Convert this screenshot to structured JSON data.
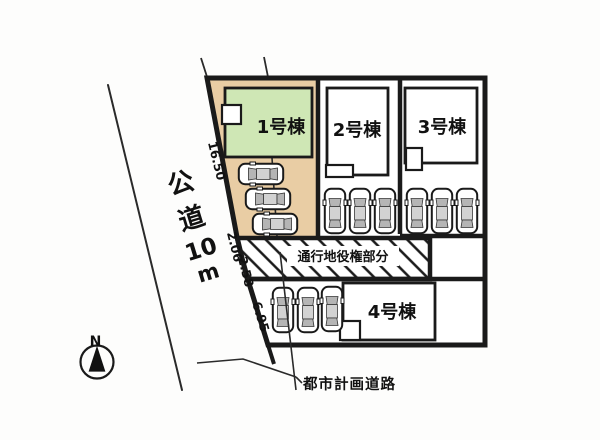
{
  "site_plan": {
    "buildings": [
      {
        "label": "1号棟"
      },
      {
        "label": "2号棟"
      },
      {
        "label": "3号棟"
      },
      {
        "label": "4号棟"
      }
    ],
    "dimensions": [
      "16.50",
      "2.06",
      "2.58",
      "6.95"
    ],
    "easement_label": "通行地役権部分",
    "planning_road_label": "都市計画道路",
    "road": {
      "label": "公道10m",
      "chars": [
        "公",
        "道",
        "10",
        "m"
      ]
    },
    "compass_label": "N",
    "parking_spaces": 12
  },
  "colors": {
    "lot1_fill": "#e9cda4",
    "building1_fill": "#cfe7b5",
    "line": "#1a1a1a"
  }
}
